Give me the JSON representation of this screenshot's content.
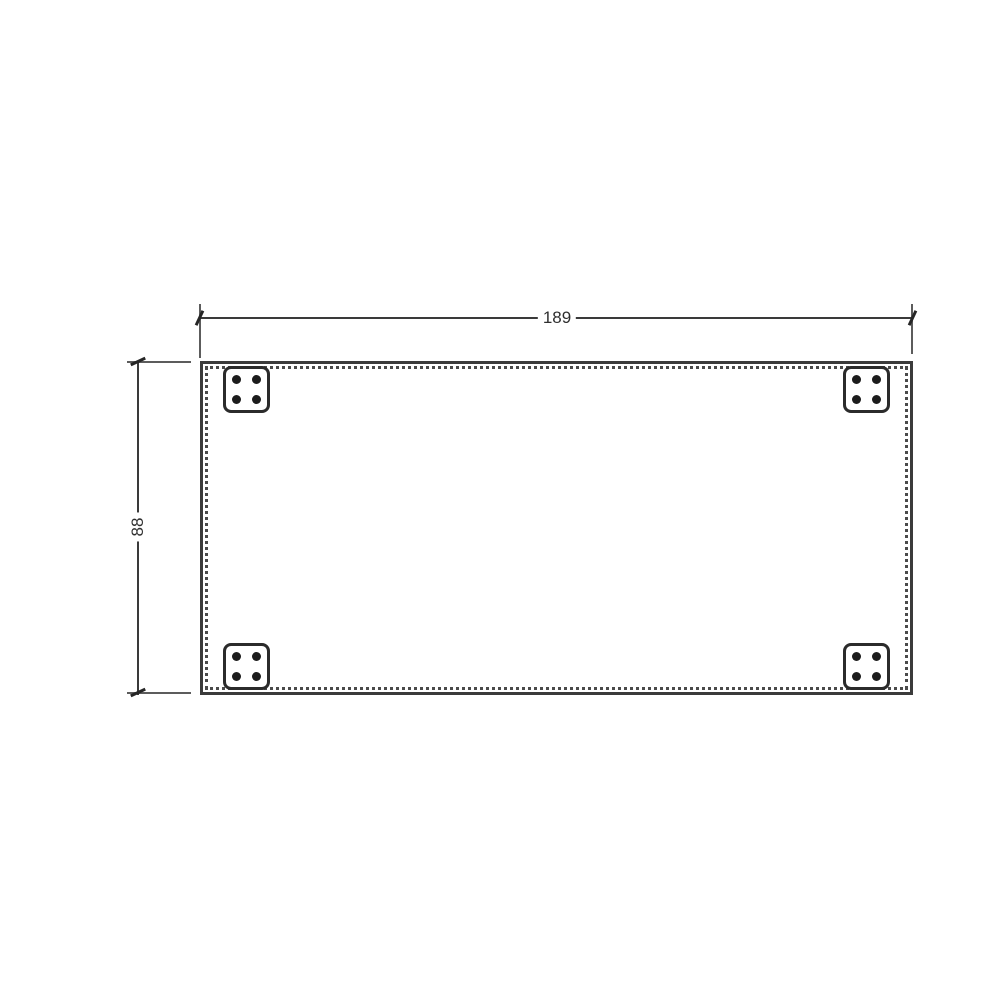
{
  "diagram": {
    "type": "technical-dimension-drawing",
    "width_dimension": {
      "value": "189"
    },
    "height_dimension": {
      "value": "88"
    },
    "panel": {
      "corner_plate_count": 4,
      "holes_per_plate": 4,
      "border_style": "solid outer line with dotted inner line"
    },
    "colors": {
      "background": "#ffffff",
      "dimension_line": "#3a3a3a",
      "extension_line": "#5c5c5c",
      "panel_border": "#3b3b3b",
      "dotted_border": "#4a4a4a",
      "plate_border": "#2b2b2b",
      "screw_hole": "#1c1c1c",
      "label_text": "#2f2f2f"
    }
  }
}
